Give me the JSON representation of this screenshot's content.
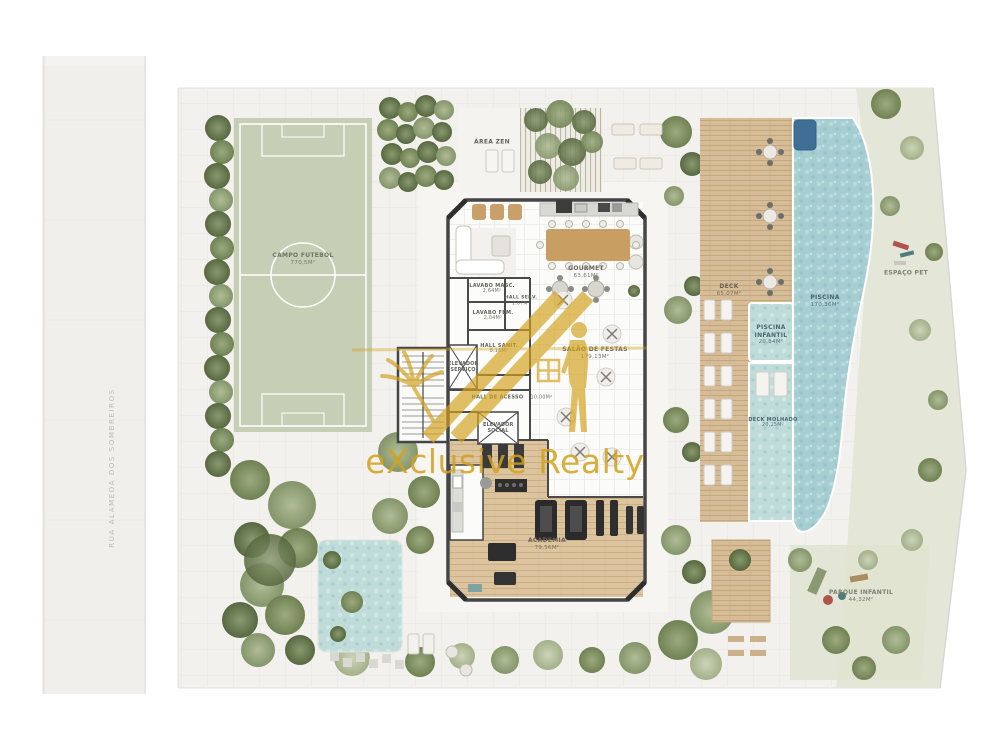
{
  "watermark": {
    "brand": "eXclusive Realty"
  },
  "street": {
    "name": "RUA ALAMEDA DOS SOMBREIROS"
  },
  "areas": {
    "campo_futebol": {
      "label": "Campo Futebol",
      "area": "770,5m²"
    },
    "area_zen": {
      "label": "Área Zen"
    },
    "gourmet": {
      "label": "Gourmet",
      "area": "63,61m²"
    },
    "lavabo_masc": {
      "label": "Lavabo Masc.",
      "area": "2,64m²"
    },
    "hall_serv": {
      "label": "Hall Serv.",
      "area": "2,07m²"
    },
    "lavabo_fem": {
      "label": "Lavabo Fem.",
      "area": "2,04m²"
    },
    "hall_sanit": {
      "label": "Hall Sanit.",
      "area": "8,16m²"
    },
    "elevador_servico": {
      "label": "Elevador Serviço"
    },
    "hall_acesso": {
      "label": "Hall de Acesso",
      "area": "10,00m²"
    },
    "elevador_social": {
      "label": "Elevador Social"
    },
    "salao_festas": {
      "label": "Salão de Festas",
      "area": "179,13m²"
    },
    "academia": {
      "label": "Academia",
      "area": "79,56m²"
    },
    "deck": {
      "label": "Deck",
      "area": "65,07m²"
    },
    "piscina": {
      "label": "Piscina",
      "area": "170,36m²"
    },
    "piscina_infantil": {
      "label": "Piscina Infantil",
      "area": "20,84m²"
    },
    "deck_molhado": {
      "label": "Deck Molhado",
      "area": "20,25m²"
    },
    "espaco_pet": {
      "label": "Espaço Pet"
    },
    "parque_infantil": {
      "label": "Parque Infantil",
      "area": "44,32m²"
    }
  },
  "colors": {
    "watermark_gold": "#d2a21e",
    "field_green": "#c6cfb5",
    "pool_water": "#a6cdd1",
    "deck_wood": "#d6bc97",
    "wall": "#454545"
  }
}
